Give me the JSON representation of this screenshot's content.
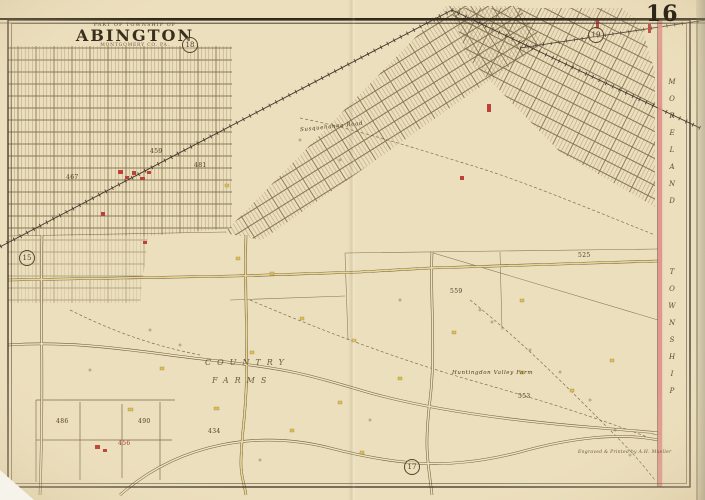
{
  "page": {
    "plate_number": "16",
    "credit": "Engraved & Printed by A.H. Mueller"
  },
  "title": {
    "kicker": "PART OF TOWNSHIP OF",
    "name": "ABINGTON",
    "subtitle": "MONTGOMERY CO. PA."
  },
  "adjoining_plates": {
    "top_left": "18",
    "top_right": "19",
    "bottom": "17",
    "left": "15"
  },
  "boundary": {
    "township_word1": "MORELAND",
    "township_word2": "TOWNSHIP"
  },
  "map_labels": {
    "estate_line1": "COUNTRY",
    "estate_line2": "FARMS",
    "farm": "Huntingdon Valley Farm",
    "road": "Susquehanna Road"
  },
  "parcel_numbers": [
    "467",
    "481",
    "459",
    "525",
    "559",
    "553",
    "456",
    "486",
    "490",
    "434"
  ],
  "colors": {
    "paper": "#ecdfbd",
    "ink": "#4a3b26",
    "boundary_pink": "#e0908b",
    "road_yellow": "#e9d386",
    "brick_red": "#bf4038",
    "frame_yellow": "#dfc04f"
  }
}
